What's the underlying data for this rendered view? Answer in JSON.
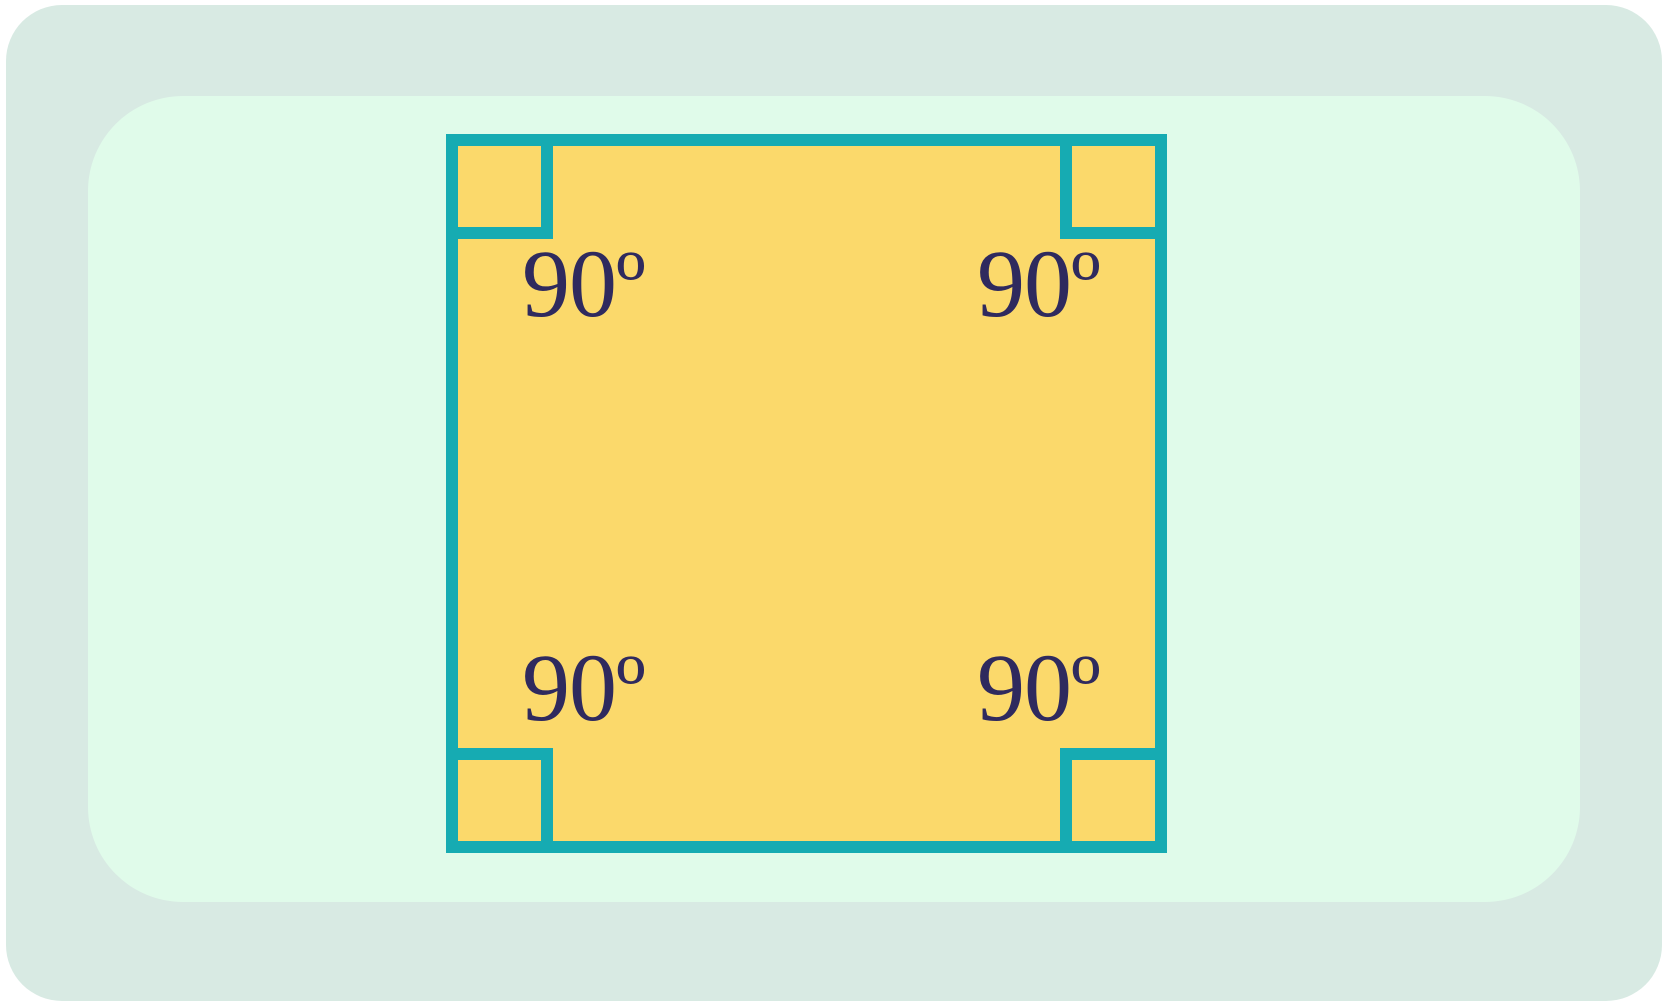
{
  "page": {
    "background": "#ffffff"
  },
  "panels": {
    "outer": {
      "color": "#d8eae3"
    },
    "inner": {
      "color": "#e0fbea"
    }
  },
  "diagram": {
    "shape": "square",
    "square": {
      "fill": "#fbd96b",
      "stroke": "#16abb2",
      "right_angle_marker_count": 4
    },
    "label_color": "#2f2a5e",
    "angle_labels": {
      "top_left": "90º",
      "top_right": "90º",
      "bottom_left": "90º",
      "bottom_right": "90º"
    }
  }
}
